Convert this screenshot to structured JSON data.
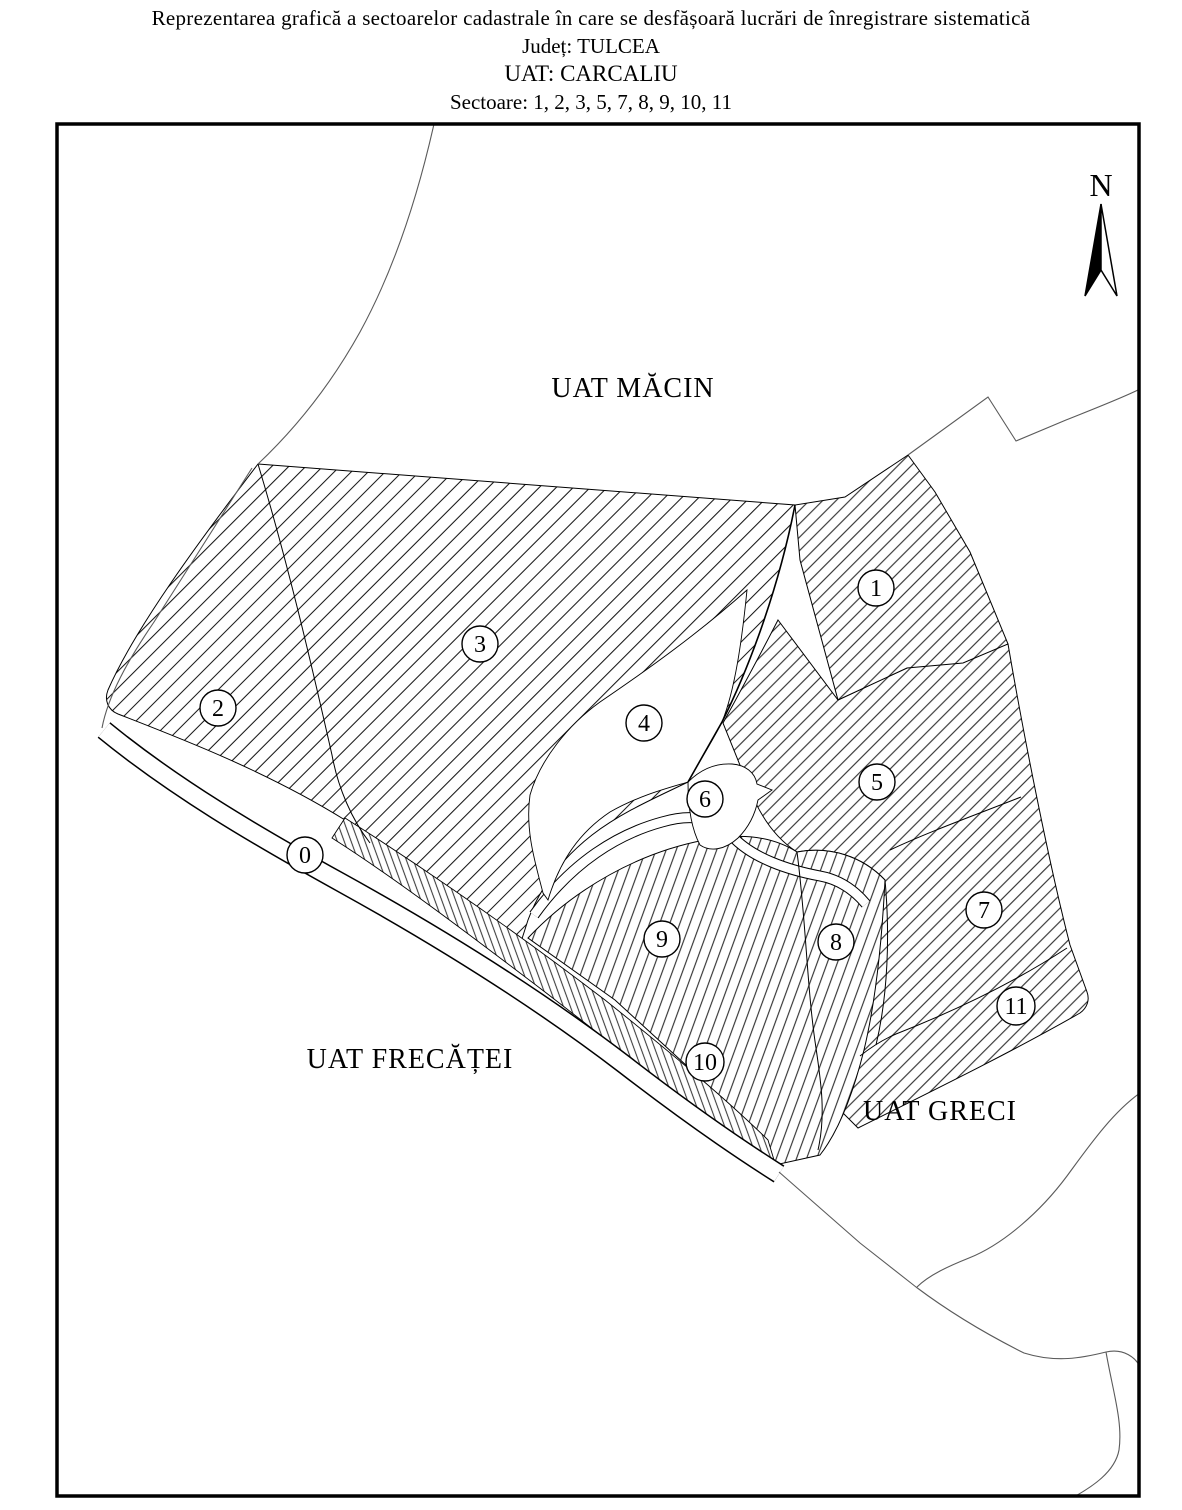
{
  "title": {
    "line1": "Reprezentarea grafică a sectoarelor cadastrale în care se desfășoară lucrări de înregistrare sistematică",
    "judet_label": "Județ: TULCEA",
    "uat_label": "UAT: CARCALIU",
    "sectors_label": "Sectoare: 1, 2, 3, 5, 7, 8, 9, 10, 11"
  },
  "map": {
    "north_label": "N",
    "neighbors": [
      {
        "name": "UAT MĂCIN"
      },
      {
        "name": "UAT FRECĂȚEI"
      },
      {
        "name": "UAT GRECI"
      }
    ],
    "sector_markers": [
      {
        "label": "0"
      },
      {
        "label": "1"
      },
      {
        "label": "2"
      },
      {
        "label": "3"
      },
      {
        "label": "4"
      },
      {
        "label": "5"
      },
      {
        "label": "6"
      },
      {
        "label": "7"
      },
      {
        "label": "8"
      },
      {
        "label": "9"
      },
      {
        "label": "10"
      },
      {
        "label": "11"
      }
    ],
    "colors": {
      "line": "#000000",
      "uat_boundary_line": "#5a5a5a",
      "background": "#ffffff"
    }
  }
}
